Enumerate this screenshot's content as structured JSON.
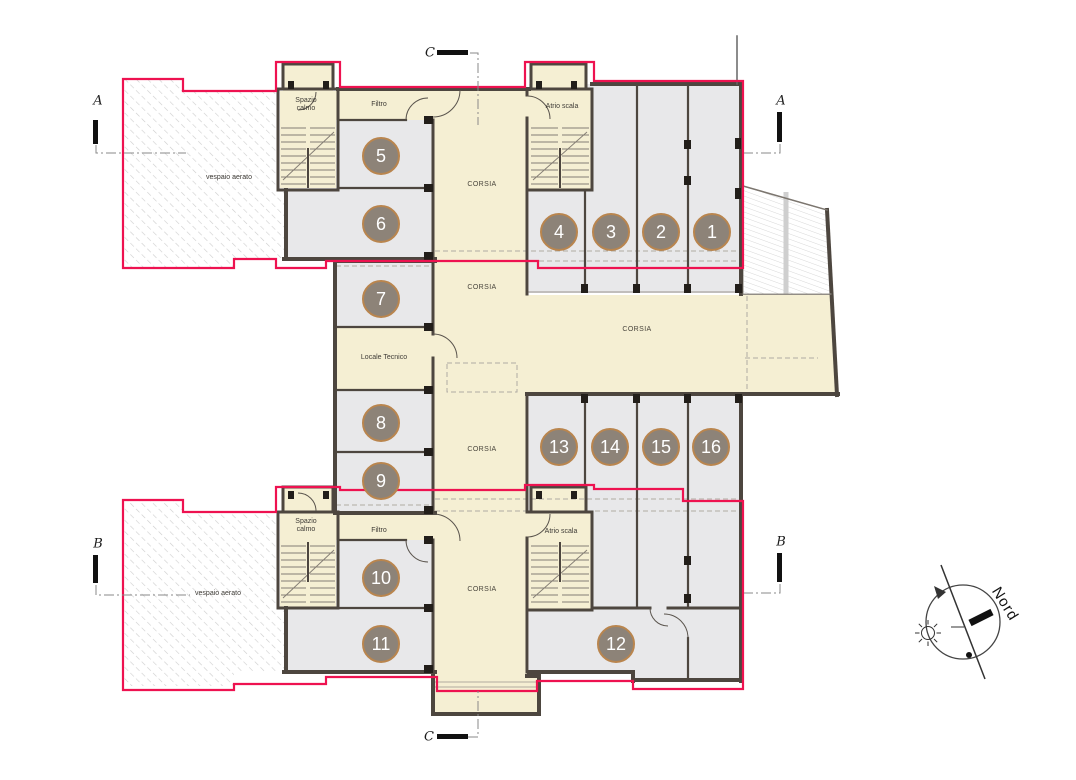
{
  "plan": {
    "labels": {
      "corsia": "CORSIA",
      "spazio_calmo": "Spazio calmo",
      "filtro": "Filtro",
      "atrio_scala": "Atrio scala",
      "locale_tecnico": "Locale Tecnico",
      "vespaio_aerato": "vespaio aerato"
    },
    "rooms": [
      {
        "number": "1"
      },
      {
        "number": "2"
      },
      {
        "number": "3"
      },
      {
        "number": "4"
      },
      {
        "number": "5"
      },
      {
        "number": "6"
      },
      {
        "number": "7"
      },
      {
        "number": "8"
      },
      {
        "number": "9"
      },
      {
        "number": "10"
      },
      {
        "number": "11"
      },
      {
        "number": "12"
      },
      {
        "number": "13"
      },
      {
        "number": "14"
      },
      {
        "number": "15"
      },
      {
        "number": "16"
      }
    ],
    "sections": {
      "a": "A",
      "b": "B",
      "c": "C"
    },
    "compass": {
      "north": "Nord"
    },
    "colors": {
      "compartment_line": "#ee1250",
      "wall": "#4d463f",
      "room_fill": "#e8e8ea",
      "corridor_fill": "#f5efd3",
      "room_tag_fill": "#8d8378",
      "room_tag_border": "#b9854e",
      "hatch_line": "#cdcdcd"
    }
  }
}
